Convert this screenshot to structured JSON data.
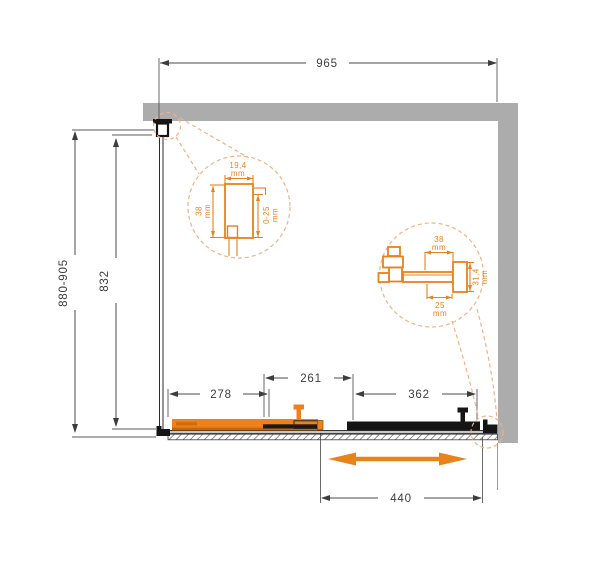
{
  "drawing": {
    "kind": "shower-enclosure-plan",
    "colors": {
      "accent_orange": "#ef811c",
      "accent_orange_dark": "#c76708",
      "detail_orange": "#e8821b",
      "leader_orange": "#f2b183",
      "wall_gray": "#acacac",
      "line_dark": "#4a4a4a",
      "part_black": "#151515"
    }
  },
  "dims": {
    "width_top": "965",
    "height_total": "880-905",
    "height_glass": "832",
    "seg_door": "278",
    "seg_overlap": "261",
    "seg_fixed": "362",
    "travel": "440"
  },
  "detail_left": {
    "width_value": "19,4",
    "width_unit": "mm",
    "height_value": "38",
    "height_unit": "mm",
    "adjust_value": "0-25",
    "adjust_unit": "mm"
  },
  "detail_right": {
    "width_value": "38",
    "width_unit": "mm",
    "height_value": "31,4",
    "height_unit": "mm",
    "depth_value": "25",
    "depth_unit": "mm"
  }
}
